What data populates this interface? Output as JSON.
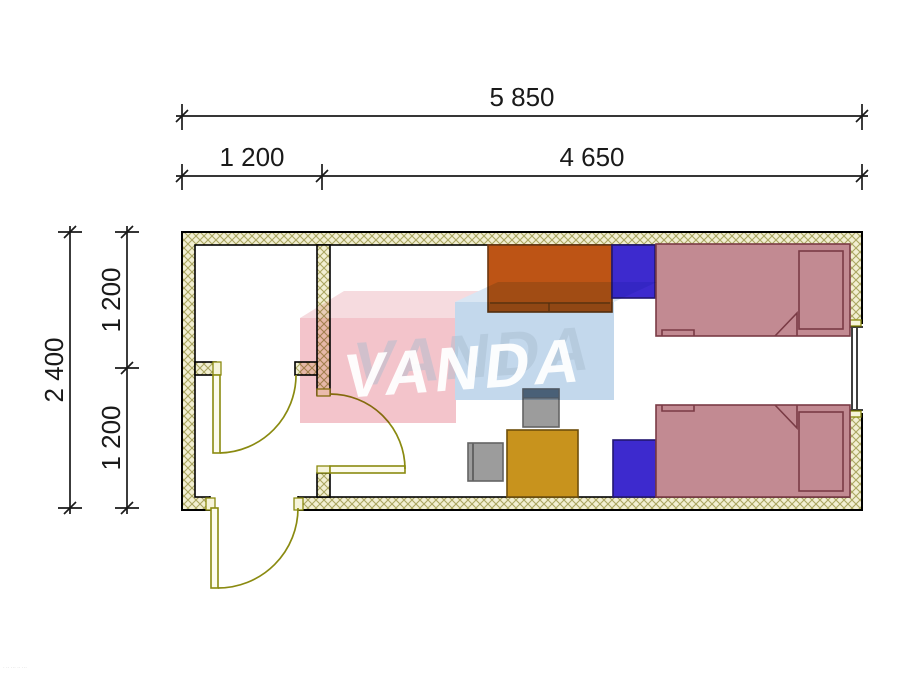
{
  "dimensions": {
    "overall_width": "5 850",
    "left_bay_width": "1 200",
    "main_room_width": "4 650",
    "overall_depth": "2 400",
    "upper_bay_depth": "1 200",
    "lower_bay_depth": "1 200"
  },
  "watermark": {
    "text": "VANDA",
    "pink_front": "#f3c4cb",
    "pink_top": "#f6dbdf",
    "blue_front": "#c3d8ec",
    "blue_top": "#d9e6f3",
    "letter_color": "#ffffff",
    "ghost_color": "#a8bccf"
  },
  "corner_note": "· ·· ··· ·· ···",
  "colors": {
    "wall_fill": "#f2efd2",
    "wall_hatch": "#aaa661",
    "outline": "#000000",
    "door": "#8a8a10",
    "wardrobe": "#bd5415",
    "wardrobe_outline": "#6b3610",
    "nightstand": "#3d2ace",
    "nightstand_outline": "#221670",
    "bed": "#c28a92",
    "bed_outline": "#7a3b45",
    "desk": "#c8931d",
    "desk_outline": "#6e4e0a",
    "chair": "#9c9c9c",
    "chair_outline": "#646464",
    "chair_back": "#5f7181",
    "dimension": "#1a1a1a"
  }
}
